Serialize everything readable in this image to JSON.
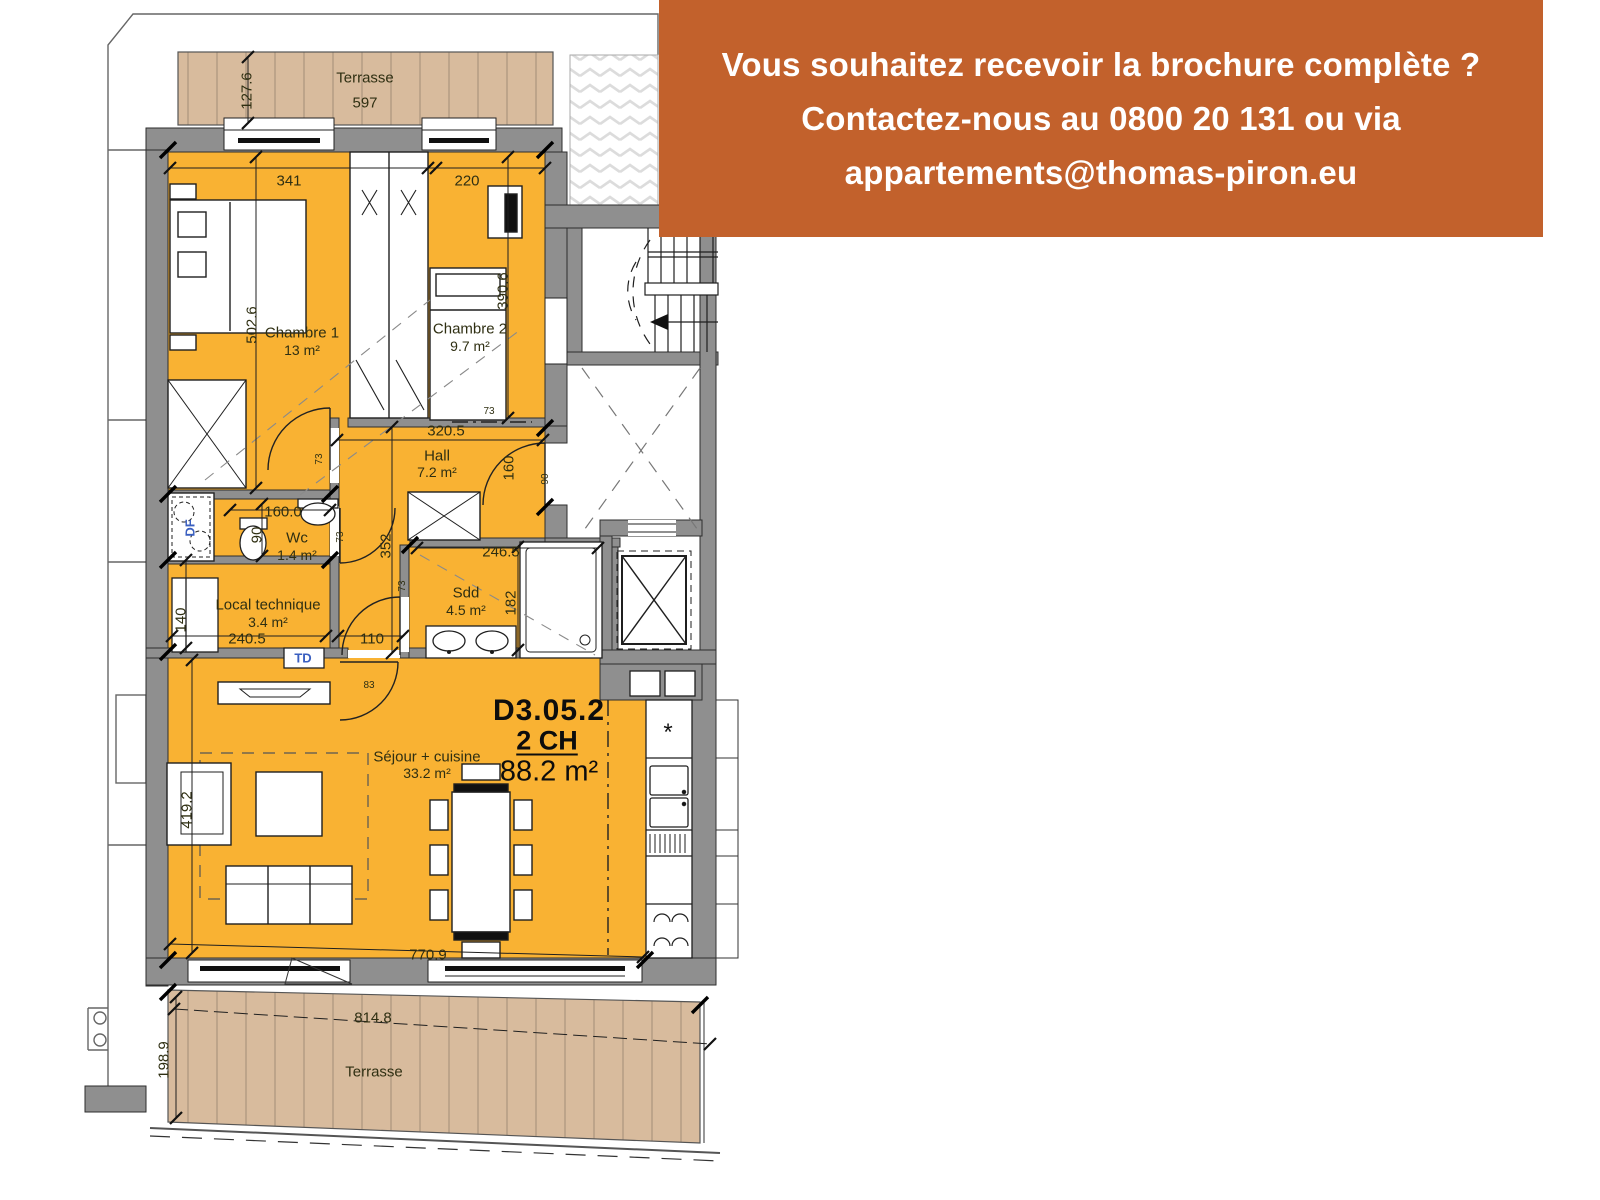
{
  "banner": {
    "line1": "Vous souhaitez recevoir la brochure complète ?",
    "line2": "Contactez-nous au 0800 20 131 ou via",
    "line3": "appartements@thomas-piron.eu",
    "bg_color": "#c2612c",
    "text_color": "#ffffff"
  },
  "apartment": {
    "code": "D3.05.2",
    "bedrooms_label": "2 CH",
    "total_area": "88.2 m²"
  },
  "rooms": {
    "terrace_top": {
      "name": "Terrasse",
      "width": "597"
    },
    "chambre1": {
      "name": "Chambre 1",
      "area": "13 m²"
    },
    "chambre2": {
      "name": "Chambre 2",
      "area": "9.7 m²"
    },
    "hall": {
      "name": "Hall",
      "area": "7.2 m²"
    },
    "wc": {
      "name": "Wc",
      "area": "1.4 m²"
    },
    "local_technique": {
      "name": "Local technique",
      "area": "3.4 m²"
    },
    "sdd": {
      "name": "Sdd",
      "area": "4.5 m²"
    },
    "sejour_cuisine": {
      "name": "Séjour + cuisine",
      "area": "33.2 m²"
    },
    "terrace_bottom": {
      "name": "Terrasse"
    }
  },
  "dimensions": {
    "terrace_top_depth": "127.6",
    "win_chambre1": "341",
    "win_chambre2": "220",
    "chambre1_depth": "502.6",
    "chambre2_depth": "390.6",
    "hall_width": "320.5",
    "entrance_door": "160",
    "door_90": "90",
    "wc_width": "160.0",
    "wc_depth": "90",
    "local_width": "240.5",
    "local_depth": "140",
    "corridor_depth": "352",
    "corridor_width": "110",
    "sdd_width": "246.5",
    "sdd_depth": "182",
    "door_73": "73",
    "door_83": "83",
    "sejour_depth": "419.2",
    "sejour_width": "770.9",
    "terrace_bottom_width": "814.8",
    "terrace_bottom_depth": "198.9"
  },
  "annotations": {
    "df": "DF",
    "td": "TD",
    "kitchen_star": "*"
  },
  "colors": {
    "banner_bg": "#c2612c",
    "apartment_fill": "#f9b233",
    "terrace_fill": "#d8bb9d",
    "wall_fill": "#8f8f8f"
  }
}
